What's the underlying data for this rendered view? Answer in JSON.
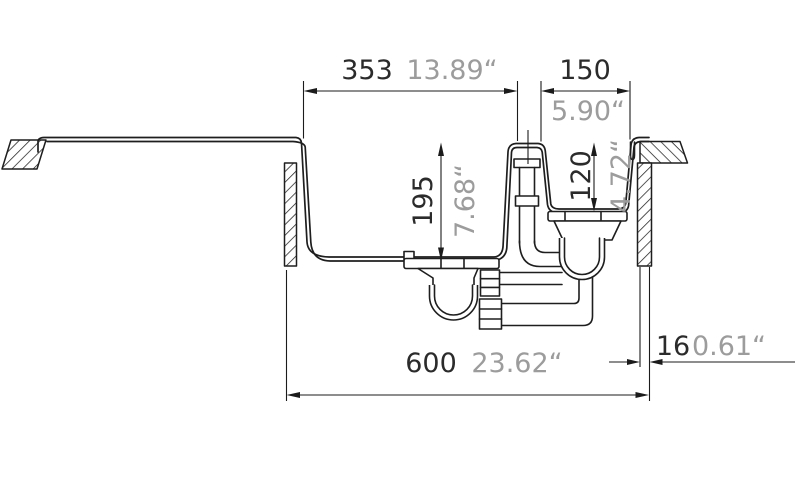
{
  "drawing": {
    "subject": "kitchen sink cross-section technical drawing with main bowl, half bowl, overflow and drain plumbing",
    "colors": {
      "background": "#ffffff",
      "line": "#1e1e1e",
      "dimension_text": "#2b2b2b",
      "inch_text": "#9c9c9c"
    },
    "dimensions": {
      "main_bowl_width": {
        "mm": "353",
        "inch": "13.89“"
      },
      "half_bowl_width": {
        "mm": "150",
        "inch": "5.90“"
      },
      "main_bowl_depth": {
        "mm": "195",
        "inch": "7.68“"
      },
      "half_bowl_depth": {
        "mm": "120",
        "inch": "4.72“"
      },
      "edge_thickness": {
        "mm": "16",
        "inch": "0.61“"
      },
      "cabinet_width": {
        "mm": "600",
        "inch": "23.62“"
      }
    }
  }
}
